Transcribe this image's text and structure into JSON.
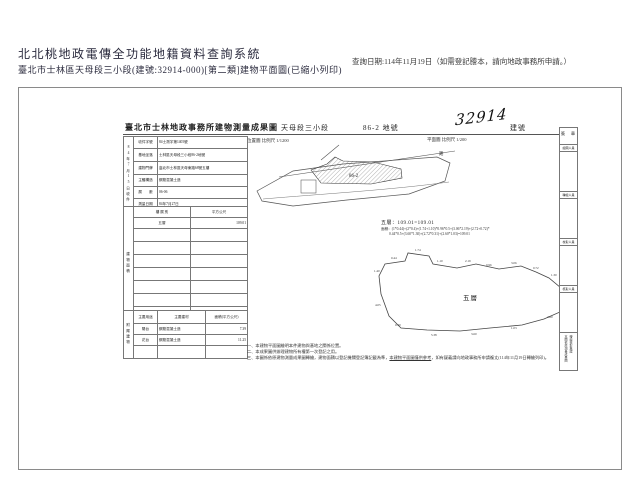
{
  "colors": {
    "header_text": "#2b2b3e",
    "ink": "#222222",
    "scan_border": "#8a8a8a"
  },
  "header": {
    "system_title": "北北桃地政電傳全功能地籍資料查詢系統",
    "subtitle": "臺北市士林區天母段三小段(建號:32914-000)[第二類]建物平面圖(已縮小列印)",
    "query_date": "查詢日期:114年11月19日（如需登記謄本，請向地政事務所申請。）"
  },
  "document": {
    "title": "臺北市士林地政事務所建物測量成果圖",
    "section": "天母段三小段",
    "lot": "86-2 地號",
    "building_no": "32914",
    "building_no_label": "建號",
    "location_scale": "位置圖 比例尺 1/1200",
    "plan_scale": "平面圖 比例尺 1/200"
  },
  "info_table": {
    "receipt": "84年7月15日收件",
    "rows": [
      {
        "label": "收件字號",
        "value": "84士測字第1405號"
      },
      {
        "label": "基地坐落",
        "value": "士林區天母段三小段86-2地號"
      },
      {
        "label": "建物門牌",
        "value": "臺北市士林區天母東路68號五樓"
      },
      {
        "label": "主體構造",
        "value": "鋼筋混凝土造"
      },
      {
        "label": "層　　數",
        "value": "06-06"
      },
      {
        "label": "測量日期",
        "value": "84年7月27日"
      }
    ]
  },
  "area_table": {
    "spine": "建物面積",
    "col_floor": "樓 層 別",
    "col_area": "平方公尺",
    "rows": [
      {
        "floor": "五層",
        "area": "109.01"
      }
    ],
    "total_label": "合　計",
    "total_area": "109.01"
  },
  "annex_table": {
    "spine": "附屬建物",
    "headers": [
      "主要用途",
      "主要建材",
      "面積(平方公尺)"
    ],
    "rows": [
      {
        "use": "陽台",
        "material": "鋼筋混凝土造",
        "area": "7.39"
      },
      {
        "use": "花台",
        "material": "鋼筋混凝土造",
        "area": "11.25"
      }
    ]
  },
  "site_plan": {
    "parcel_label": "86-2",
    "road_label": "路"
  },
  "calc": {
    "line1": "五層：109.01=109.01",
    "line2": "面積：(1*0.44)+(2*0.4)+(1.74+1.10)*0.96*0.5+(3.06*2.19)+(2.72+0.72)*",
    "line3": "0.44*0.5+(3.60*1.30)+(2.72*0.31)+(2.60*1.03)=109.01"
  },
  "floor_plan": {
    "label": "五層",
    "dims": [
      {
        "x": 20,
        "y": 13,
        "t": "0.44"
      },
      {
        "x": 44,
        "y": 5,
        "t": "1.74"
      },
      {
        "x": 66,
        "y": 16,
        "t": "1.10"
      },
      {
        "x": 94,
        "y": 16,
        "t": "2.19"
      },
      {
        "x": 115,
        "y": 20,
        "t": "0.96"
      },
      {
        "x": 140,
        "y": 18,
        "t": "3.06"
      },
      {
        "x": 162,
        "y": 23,
        "t": "0.72"
      },
      {
        "x": 180,
        "y": 30,
        "t": "1.30"
      },
      {
        "x": 193,
        "y": 40,
        "t": "2.72"
      },
      {
        "x": 194,
        "y": 60,
        "t": "0.31"
      },
      {
        "x": 176,
        "y": 72,
        "t": "2.60"
      },
      {
        "x": 140,
        "y": 83,
        "t": "1.03"
      },
      {
        "x": 100,
        "y": 89,
        "t": "3.60"
      },
      {
        "x": 60,
        "y": 90,
        "t": "5.38"
      },
      {
        "x": 24,
        "y": 80,
        "t": "0.40"
      },
      {
        "x": 4,
        "y": 60,
        "t": "4.05"
      },
      {
        "x": 3,
        "y": 26,
        "t": "1.40"
      }
    ]
  },
  "notes": {
    "n1": "一、本建物平面圖繪明本件建物與基地之關係位置。",
    "n2": "二、本成果圖供辦理建物所有權第一次登記之用。",
    "n3_pre": "三、本圖係依原建物測量成果圖轉繪，建物面積以登記機關登記簿記載為準，",
    "n3_underline": "本建物平面圖僅供參考",
    "n3_post": "，如有疑義請向地政事務所申請複丈(114年11月19日轉繪列印)。"
  },
  "sign": {
    "header": "簽　章",
    "fields": [
      "繪圖人員",
      "轉繪人員",
      "校對人員",
      "核對人員"
    ],
    "stamp_line1": "本圖依原測量成果圖",
    "stamp_line2": "轉繪核對無誤"
  }
}
